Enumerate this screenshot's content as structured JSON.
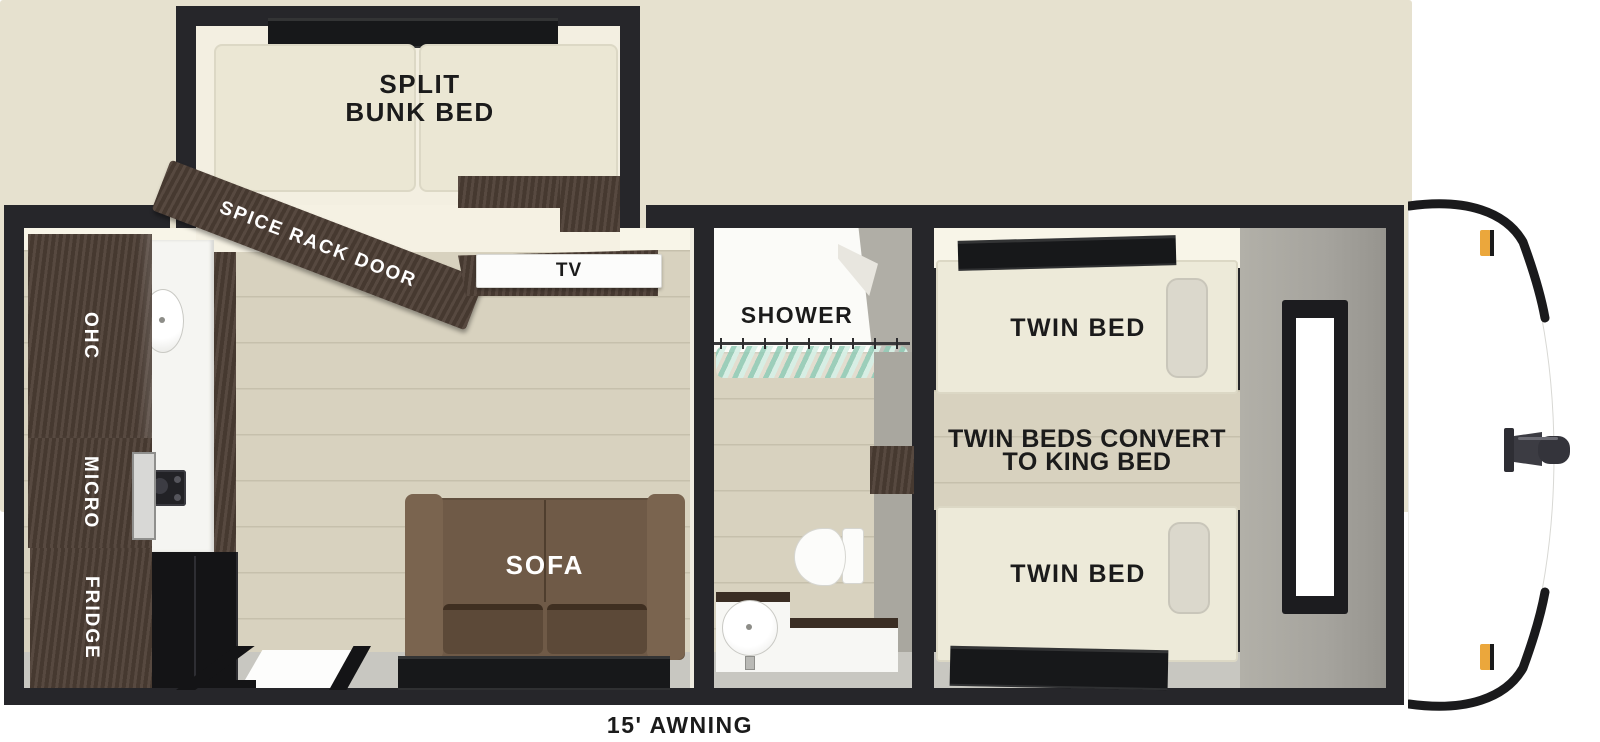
{
  "labels": {
    "bunk_room": {
      "line1": "SPLIT",
      "line2": "BUNK BED"
    },
    "spice_rack_door": "SPICE RACK DOOR",
    "tv": "TV",
    "kitchen": {
      "ohc": "OHC",
      "micro": "MICRO",
      "fridge": "FRIDGE"
    },
    "sofa": "SOFA",
    "bathroom": {
      "shower": "SHOWER"
    },
    "bedroom": {
      "twin_bed_top": "TWIN BED",
      "twin_bed_bottom": "TWIN BED",
      "convert_line1": "TWIN BEDS CONVERT",
      "convert_line2": "TO KING BED"
    },
    "awning": "15' AWNING"
  },
  "colors": {
    "wall": "#26262a",
    "outer_trim": "#e6e1cf",
    "floor_wood": "#d8d2bf",
    "cabinet_wood": "#4e3f36",
    "mattress": "#ebe7d4",
    "sofa": "#6f5a47",
    "shower_curtain": "#a8d5c4",
    "bath_wall_gray": "#a9a79f",
    "marker_light": "#eba73c",
    "label_dark": "#1b1b1b",
    "label_light": "#ffffff"
  }
}
